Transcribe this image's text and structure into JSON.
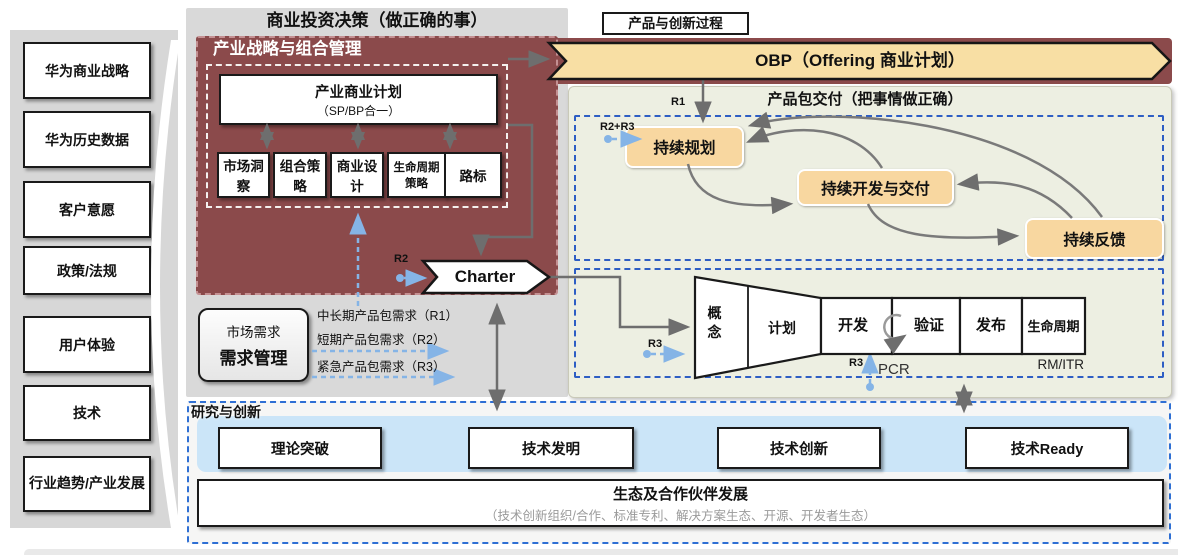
{
  "sidebar": {
    "items": [
      {
        "label": "华为商业战略"
      },
      {
        "label": "华为历史数据"
      },
      {
        "label": "客户意愿"
      },
      {
        "label": "政策/法规"
      },
      {
        "label": "用户体验"
      },
      {
        "label": "技术"
      },
      {
        "label": "行业趋势/产业发展"
      }
    ]
  },
  "header": {
    "title": "商业投资决策（做正确的事）",
    "process_tag": "产品与创新过程"
  },
  "strategy": {
    "title": "产业战略与组合管理",
    "plan_line1": "产业商业计划",
    "plan_line2": "（SP/BP合一）",
    "sub_boxes": [
      {
        "label": "市场洞察"
      },
      {
        "label": "组合策略"
      },
      {
        "label": "商业设计"
      },
      {
        "label": "生命周期策略"
      },
      {
        "label": "路标"
      }
    ]
  },
  "obp": {
    "label": "OBP（Offering 商业计划）"
  },
  "delivery": {
    "title": "产品包交付（把事情做正确）",
    "r1_label": "R1",
    "r2r3_label": "R2+R3",
    "loops": [
      {
        "label": "持续规划"
      },
      {
        "label": "持续开发与交付"
      },
      {
        "label": "持续反馈"
      }
    ],
    "pipeline": {
      "funnel_stage1": "概念",
      "funnel_stage2": "计划",
      "stages": [
        {
          "label": "开发"
        },
        {
          "label": "验证"
        },
        {
          "label": "发布"
        },
        {
          "label": "生命周期"
        }
      ],
      "r3_input_label": "R3",
      "r3_pcr_label": "R3",
      "pcr_label": "PCR",
      "rm_itr_label": "RM/ITR"
    }
  },
  "charter": {
    "label": "Charter",
    "r2_label": "R2"
  },
  "requirements": {
    "box_top": "市场需求",
    "box_main": "需求管理",
    "lines": [
      {
        "label": "中长期产品包需求（R1）"
      },
      {
        "label": "短期产品包需求（R2）"
      },
      {
        "label": "紧急产品包需求（R3）"
      }
    ]
  },
  "research": {
    "title": "研究与创新",
    "boxes": [
      {
        "label": "理论突破"
      },
      {
        "label": "技术发明"
      },
      {
        "label": "技术创新"
      },
      {
        "label": "技术Ready"
      }
    ],
    "eco_title": "生态及合作伙伴发展",
    "eco_subtitle": "（技术创新组织/合作、标准专利、解决方案生态、开源、开发者生态）"
  },
  "colors": {
    "dark_red": "#8b4a4b",
    "obp_cream": "#f8dfa4",
    "loop_orange": "#f8d7a0",
    "delivery_green": "#edefe2",
    "blue_dash": "#2e5ec4",
    "light_blue_arrow": "#85b4e6",
    "research_blue": "#cbe5f8",
    "sidebar_gray": "#d7d7d7",
    "arrow_gray": "#6e6e6e"
  }
}
